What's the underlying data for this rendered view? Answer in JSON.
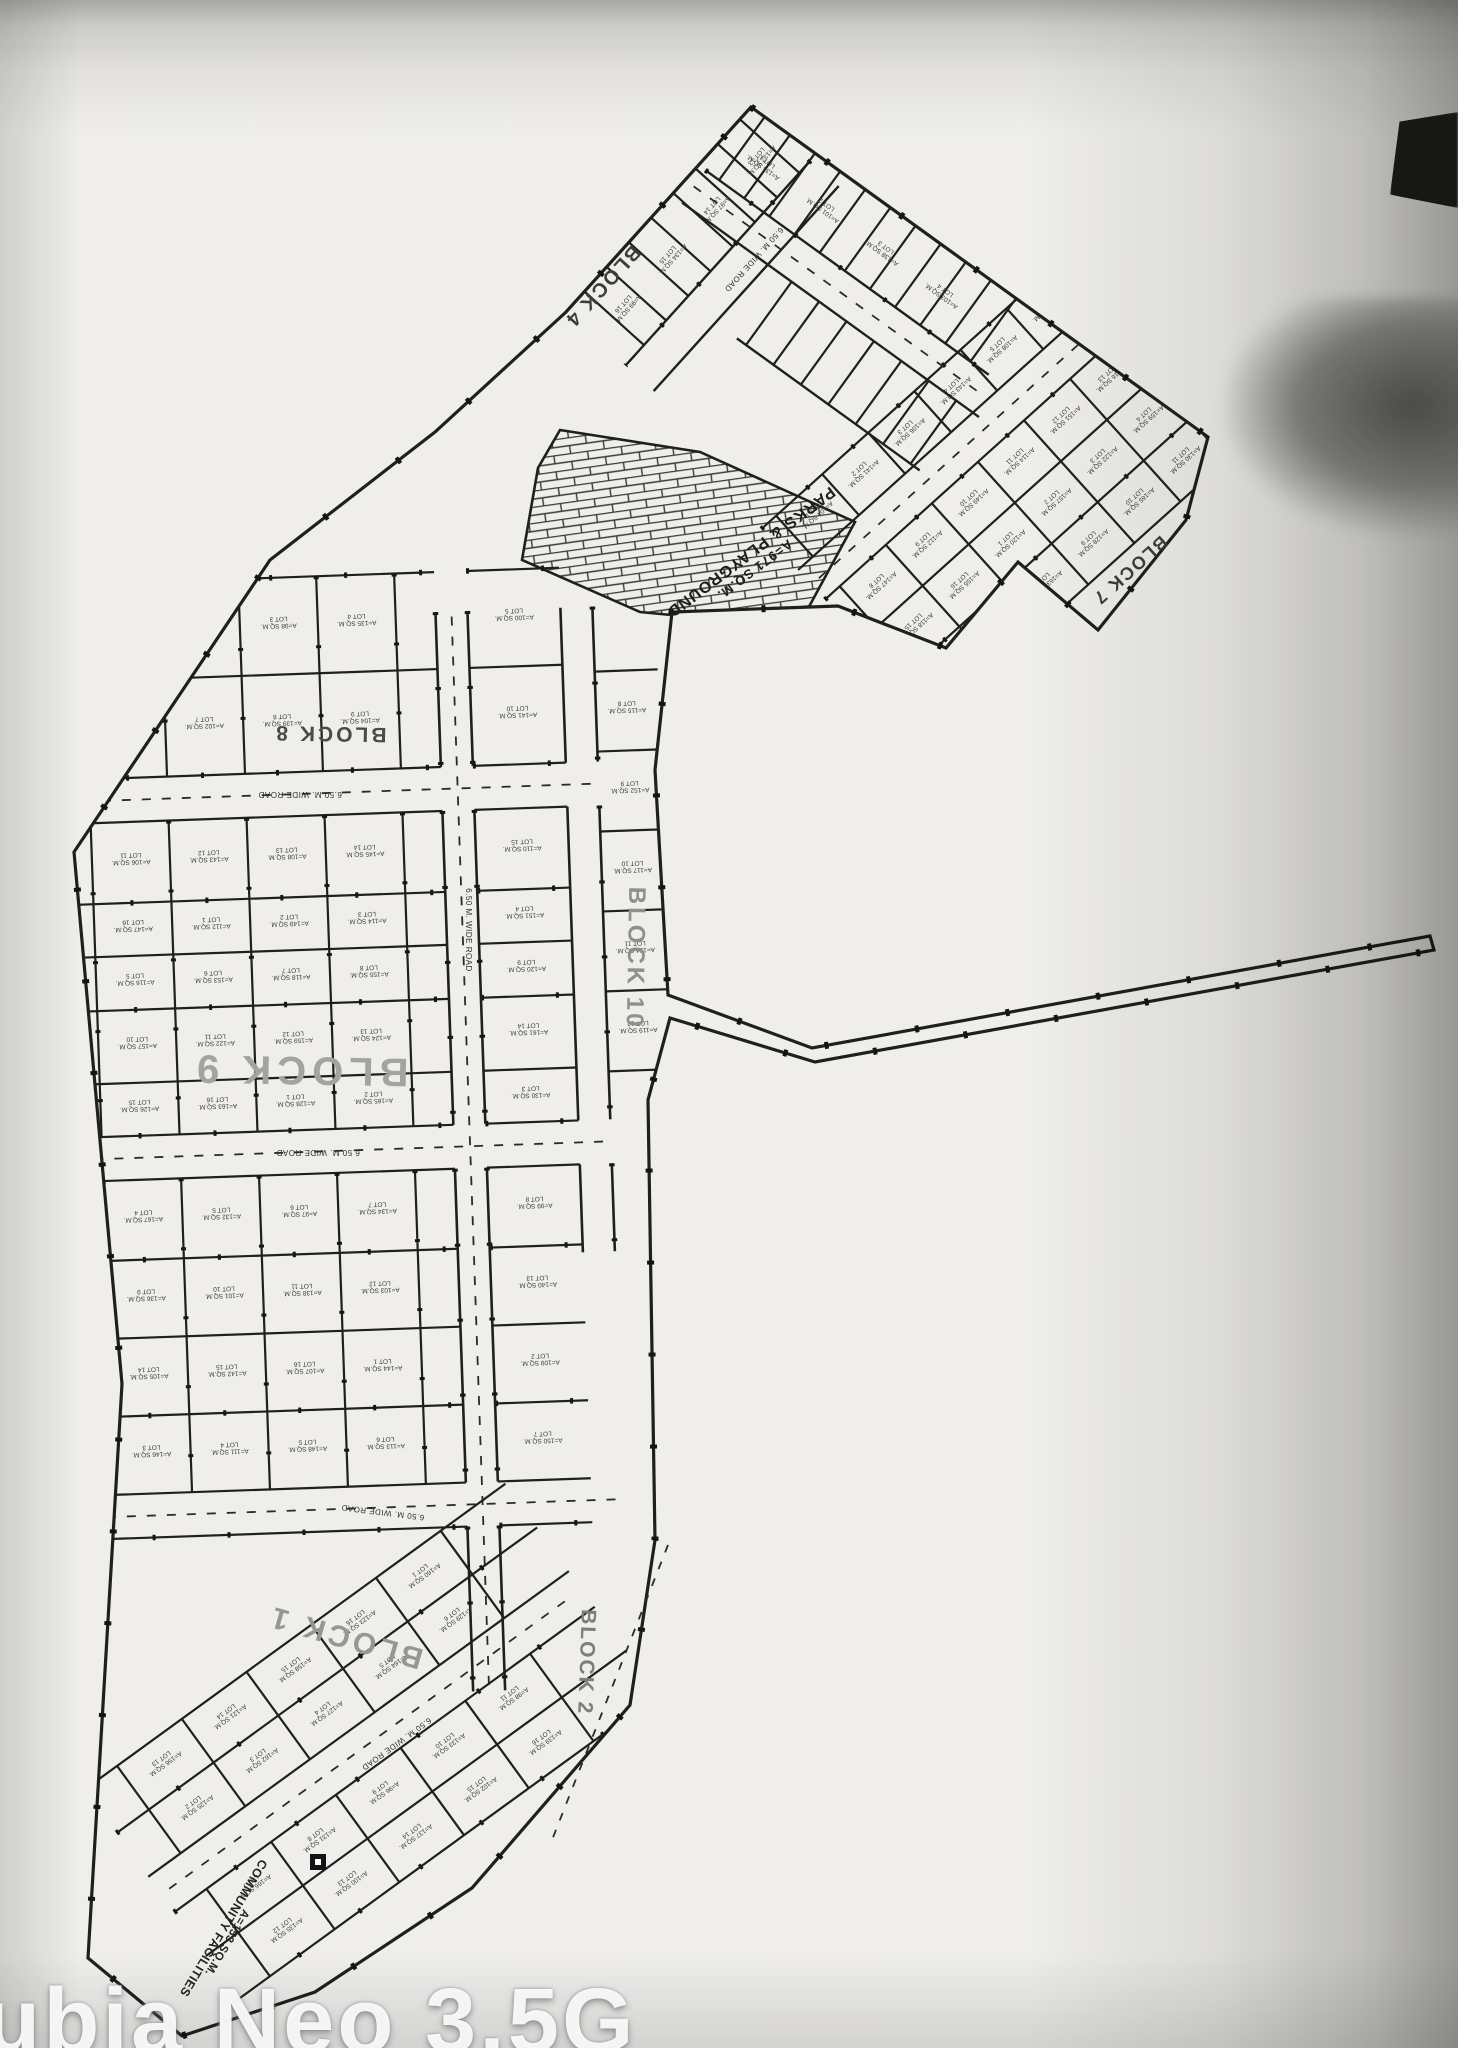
{
  "photo": {
    "watermark": "ubia Neo 3.5G"
  },
  "plan": {
    "block_labels": [
      {
        "id": "block-4",
        "text": "BLOCK 4"
      },
      {
        "id": "block-7",
        "text": "BLOCK 7"
      },
      {
        "id": "block-8",
        "text": "BLOCK 8"
      },
      {
        "id": "block-9",
        "text": "BLOCK 9"
      },
      {
        "id": "block-10",
        "text": "BLOCK 10"
      },
      {
        "id": "block-1",
        "text": "BLOCK 1"
      },
      {
        "id": "block-2",
        "text": "BLOCK 2"
      }
    ],
    "park_label": {
      "line1": "PARKS & PLAYGROUND",
      "line2": "A=971 SQ.M."
    },
    "community_label": {
      "line1": "COMMUNITY FACILITIES",
      "line2": "A=153 SQ.M."
    },
    "road_label": "6.50 M. WIDE ROAD",
    "lot_label": {
      "area_prefix": "A=",
      "area_unit": "SQ.M.",
      "lot_prefix": "LOT"
    }
  },
  "colors": {
    "ink": "#1f1f1d",
    "paper": "#efeeec",
    "gray_label": "#9a9a98",
    "hatch": "#2e2e2c"
  }
}
